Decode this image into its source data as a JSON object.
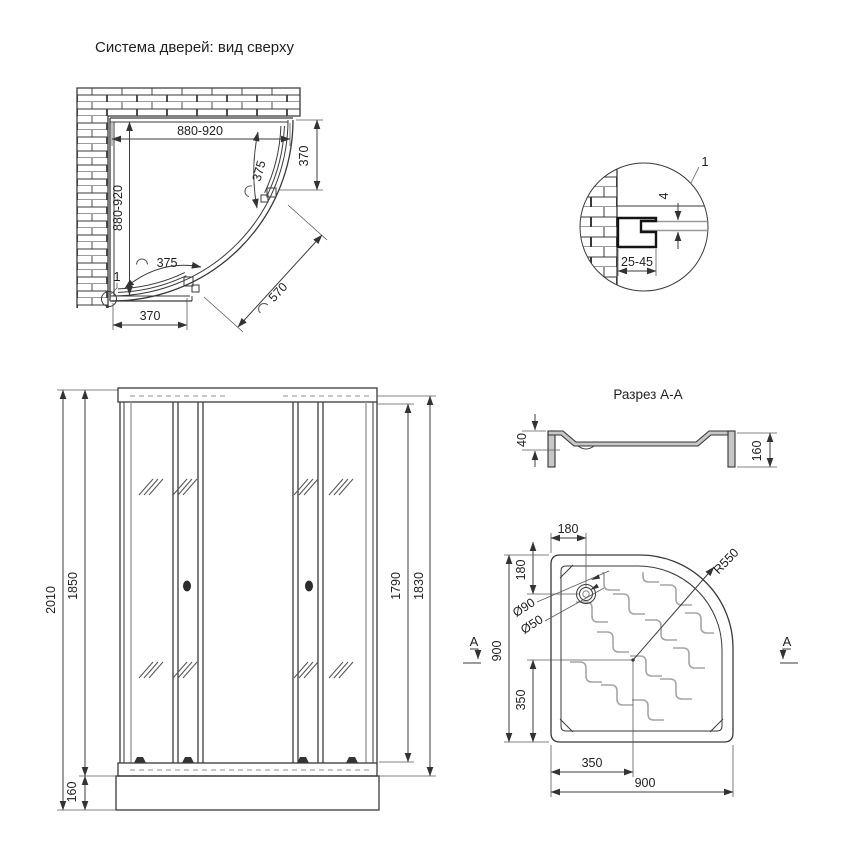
{
  "top_view": {
    "title": "Система дверей: вид сверху",
    "width_label": "880-920",
    "depth_label": "880-920",
    "side_fixed_label": "370",
    "bottom_fixed_label": "370",
    "door_top_label": "375",
    "door_bottom_label": "375",
    "opening_label": "570",
    "detail_ref_label": "1"
  },
  "detail_view": {
    "ref_label": "1",
    "glass_thickness_label": "4",
    "adjustment_range_label": "25-45"
  },
  "front_view": {
    "total_height_label": "2010",
    "frame_height_label": "1850",
    "tray_height_label": "160",
    "door_glass_height_label": "1790",
    "glass_height_label": "1830"
  },
  "section_view": {
    "title": "Разрез А-А",
    "depth_label": "40",
    "height_label": "160"
  },
  "tray_view": {
    "drain_offset_x_label": "180",
    "drain_offset_y_label": "180",
    "drain_outer_label": "Ø90",
    "drain_inner_label": "Ø50",
    "radius_label": "R550",
    "width_label": "900",
    "depth_label": "900",
    "center_x_label": "350",
    "center_y_label": "350",
    "section_marker": "A"
  }
}
